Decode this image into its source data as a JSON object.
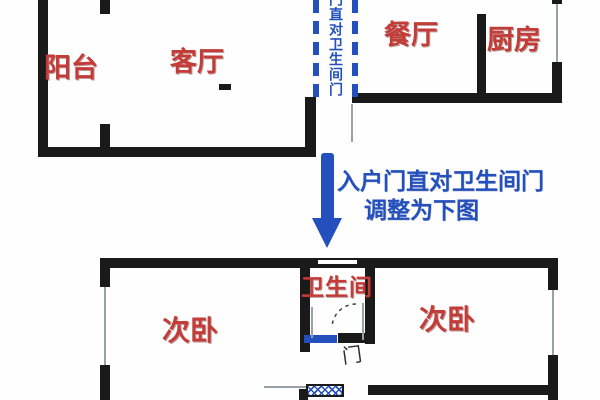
{
  "colors": {
    "wall": "#1a1a1a",
    "room_label": "#c43c38",
    "accent_blue": "#2350bc",
    "door_label": "#2e2e2e"
  },
  "top_plan": {
    "balcony_label": "阳台",
    "living_label": "客厅",
    "dining_label": "餐厅",
    "kitchen_label": "厨房",
    "sightline_text": "门直对卫生间门"
  },
  "transition": {
    "arrow_icon": "down-arrow",
    "line1": "入户门直对卫生间门",
    "line2": "调整为下图"
  },
  "bottom_plan": {
    "bedroom_left_label": "次卧",
    "bathroom_label": "卫生间",
    "bedroom_right_label": "次卧",
    "door_label": "门"
  }
}
